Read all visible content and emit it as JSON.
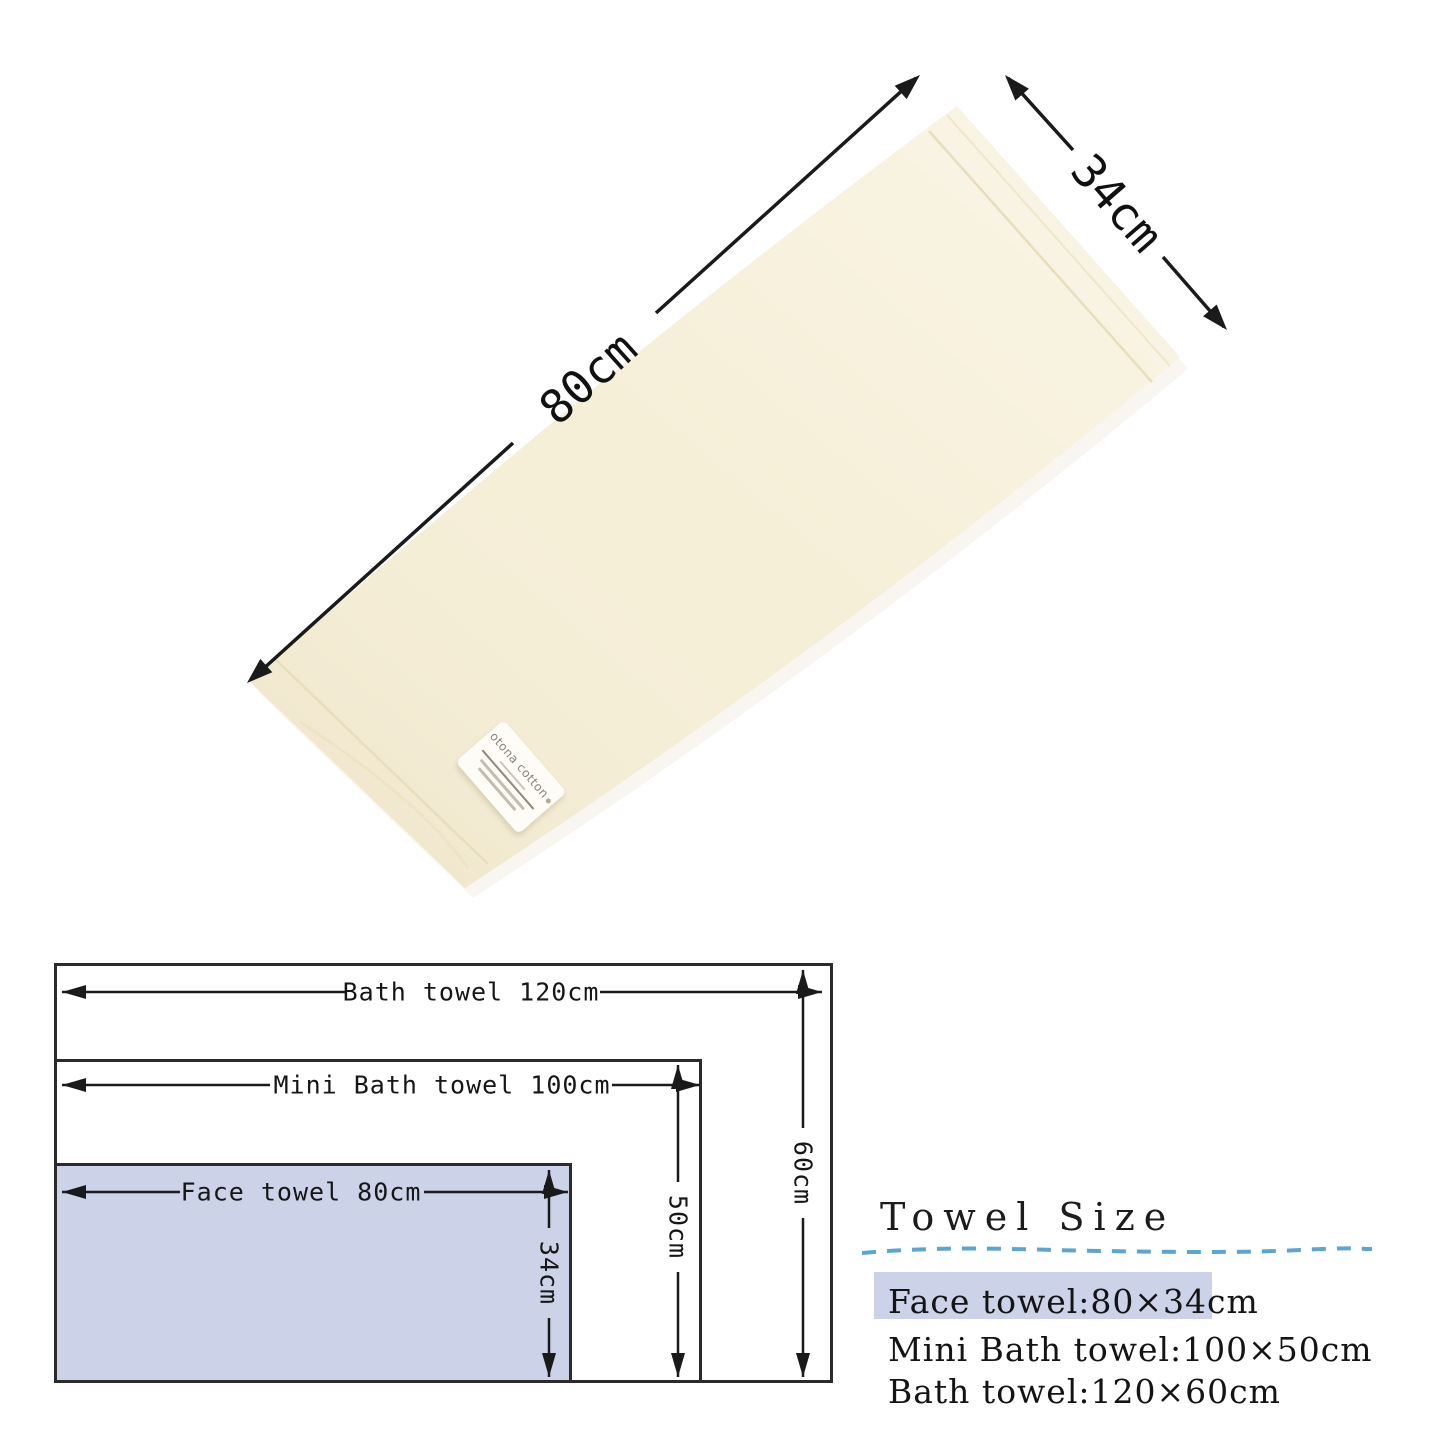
{
  "photo": {
    "long_dim_label": "80cm",
    "short_dim_label": "34cm",
    "tag_brand": "otona cotton"
  },
  "diagram": {
    "bath_width_label": "Bath towel 120cm",
    "bath_height_label": "60cm",
    "mini_width_label": "Mini Bath towel 100cm",
    "mini_height_label": "50cm",
    "face_width_label": "Face towel 80cm",
    "face_height_label": "34cm"
  },
  "size_panel": {
    "title": "Towel Size",
    "items": [
      {
        "label": "Face towel:80×34cm",
        "highlighted": true
      },
      {
        "label": "Mini Bath towel:100×50cm",
        "highlighted": false
      },
      {
        "label": "Bath towel:120×60cm",
        "highlighted": false
      }
    ]
  },
  "colors": {
    "towel": "#f6efd8",
    "towel_edge": "#e9ddbc",
    "highlight": "#ccd3e9",
    "dashed_line": "#3e96c8",
    "line": "#1a1a1a"
  }
}
